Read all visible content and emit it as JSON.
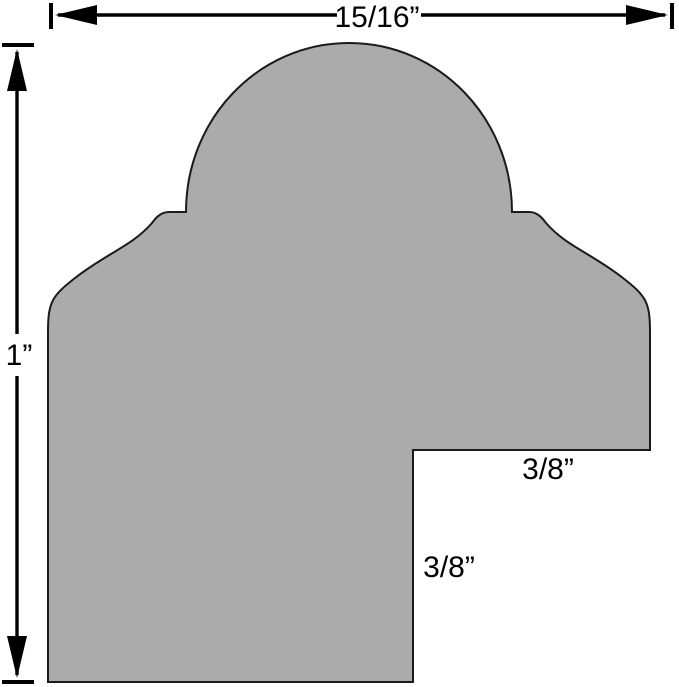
{
  "figure": {
    "profile_fill": "#ababab",
    "outline_color": "#1b1b1b",
    "dimension_color": "#000000",
    "background": "#ffffff"
  },
  "dimensions": {
    "overall_width": "15/16”",
    "overall_height": "1”",
    "rabbet_width": "3/8”",
    "rabbet_depth": "3/8”"
  }
}
